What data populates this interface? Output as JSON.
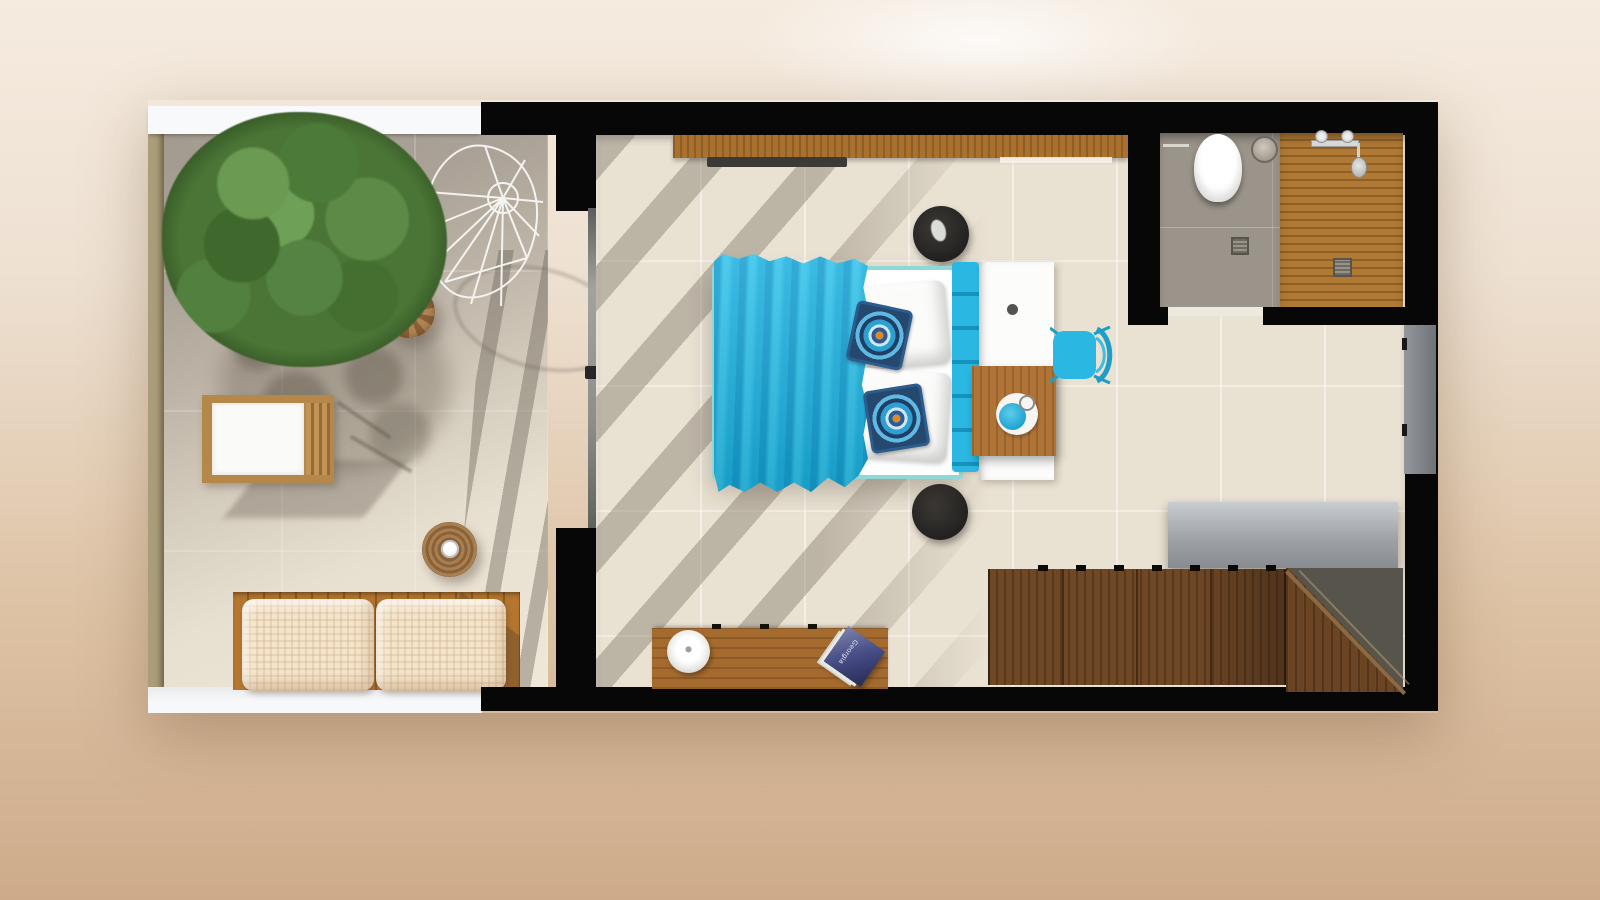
{
  "scene": {
    "type": "3d-floor-plan-top-view",
    "description": "Top-down 3D render of a studio suite: open terrace with tree, bedroom with turquoise double bed, en-suite bathroom with wooden shower deck, wardrobe and staircase",
    "rooms": [
      {
        "name": "terrace",
        "items": [
          "tree",
          "hanging wire chair",
          "rattan pouf",
          "sun lounger",
          "round rattan side table with cup",
          "wooden bench",
          "two checkered beige pillows"
        ]
      },
      {
        "name": "bedroom",
        "items": [
          "double bed with turquoise throw",
          "white bed pillows",
          "two turquoise mandala cushions",
          "tufted turquoise headboard",
          "white console with knob",
          "wooden desk with tray and turquoise bowl",
          "turquoise chair",
          "wall shelf",
          "wall-mounted TV",
          "black round stool top",
          "black round stool bottom",
          "media bench",
          "white round lamp",
          "magazine",
          "sliding glass door to terrace"
        ]
      },
      {
        "name": "bathroom",
        "items": [
          "toilet",
          "round flush plate",
          "towel hook",
          "floor drain",
          "wooden shower deck",
          "shower fixtures",
          "hand shower",
          "shower drain",
          "door threshold"
        ]
      },
      {
        "name": "stair-area",
        "items": [
          "grey counter top",
          "wooden wardrobe with sliding doors",
          "wooden staircase",
          "grey wall panel"
        ]
      }
    ]
  },
  "magazine": {
    "title": "Georgia"
  },
  "colors": {
    "bg_top": "#f5ebdf",
    "bg_bottom": "#cdab8a",
    "wall_black": "#070707",
    "wall_white": "#f8f9fb",
    "wall_tan": "#aa9d79",
    "floor_cream": "#e9e1d1",
    "terrace_light": "#efe8d8",
    "accent": "#2ab8e3",
    "accent_dark": "#1693bb",
    "teal_frame": "#8fd8d6",
    "wood_shelf": "#a9702e",
    "wood_desk": "#b07437",
    "wood_bench": "#a56a2e",
    "wood_terrace": "#b5762f",
    "wood_dark": "#6f4725",
    "wood_stairs": "#6b4423",
    "wood_shower": "#b07a35",
    "grey_counter": "#888c91",
    "grey_bath": "#9b948a",
    "olive": "#57554b",
    "tree_green": "#4a7536",
    "pillow_beige": "#f4e4ca"
  }
}
